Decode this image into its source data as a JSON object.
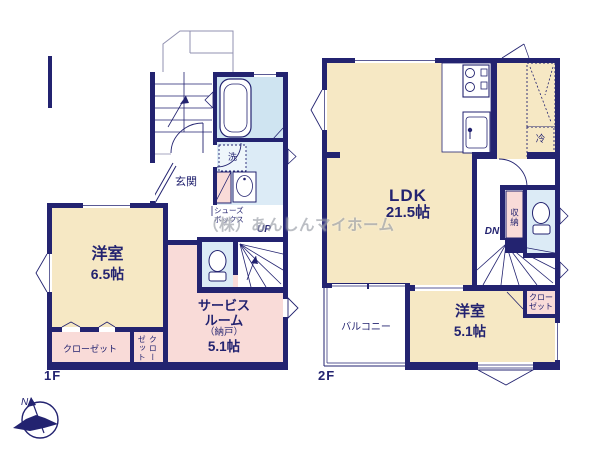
{
  "watermark": "（株）あんしんマイホーム",
  "floor1": {
    "label": "1F",
    "entrance": "玄関",
    "western_name": "洋室",
    "western_size": "6.5帖",
    "service_line1": "サービス",
    "service_line2": "ルーム",
    "service_line3": "（納戸）",
    "service_size": "5.1帖",
    "closet": "クローゼット",
    "closet_side": "クローゼット",
    "shoes_line1": "シューズ",
    "shoes_line2": "ボックス",
    "laundry": "洗",
    "up": "UP"
  },
  "floor2": {
    "label": "2F",
    "ldk_name": "LDK",
    "ldk_size": "21.5帖",
    "western_name": "洋室",
    "western_size": "5.1帖",
    "balcony": "バルコニー",
    "closet_line1": "クロー",
    "closet_line2": "ゼット",
    "storage": "収納",
    "fridge": "冷",
    "dn": "DN"
  },
  "compass": {
    "north": "N"
  },
  "colors": {
    "wall": "#232370",
    "wood_floor": "#f6e8c4",
    "pink_room": "#f9dbd8",
    "bath_room": "#cfe4f1",
    "wet_room": "#dcebf6",
    "watermark_gray": "#7d828e"
  }
}
